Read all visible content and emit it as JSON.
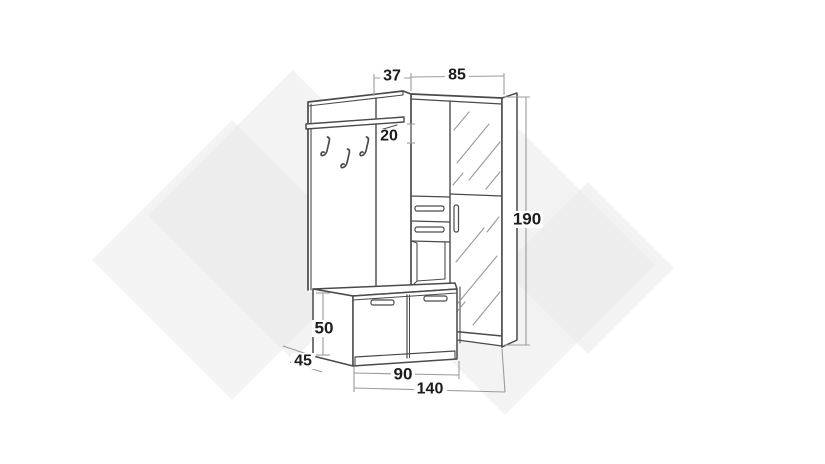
{
  "diagram": {
    "kind": "technical line drawing of a hallway furniture set",
    "components": {
      "left_section": "coat panel with shelf and three hooks",
      "center_section": "cabinet column with door, two drawers and open niche",
      "right_section": "tall mirrored wardrobe door",
      "bottom_section": "shoe bench with two doors"
    },
    "dimensions": {
      "panel_top_width": "37",
      "wardrobe_top_width": "85",
      "shelf_gap": "20",
      "total_height": "190",
      "bench_height": "50",
      "bench_depth": "45",
      "bench_width": "90",
      "total_width": "140"
    },
    "colors": {
      "outline": "#4a4a4a",
      "inner_line": "#5a5a5a",
      "dimension_line": "#9b9b9b",
      "hatch_line": "#9a9a9a",
      "label_text": "#1c1c1c",
      "watermark": "#ededed",
      "surface": "#ffffff"
    }
  }
}
